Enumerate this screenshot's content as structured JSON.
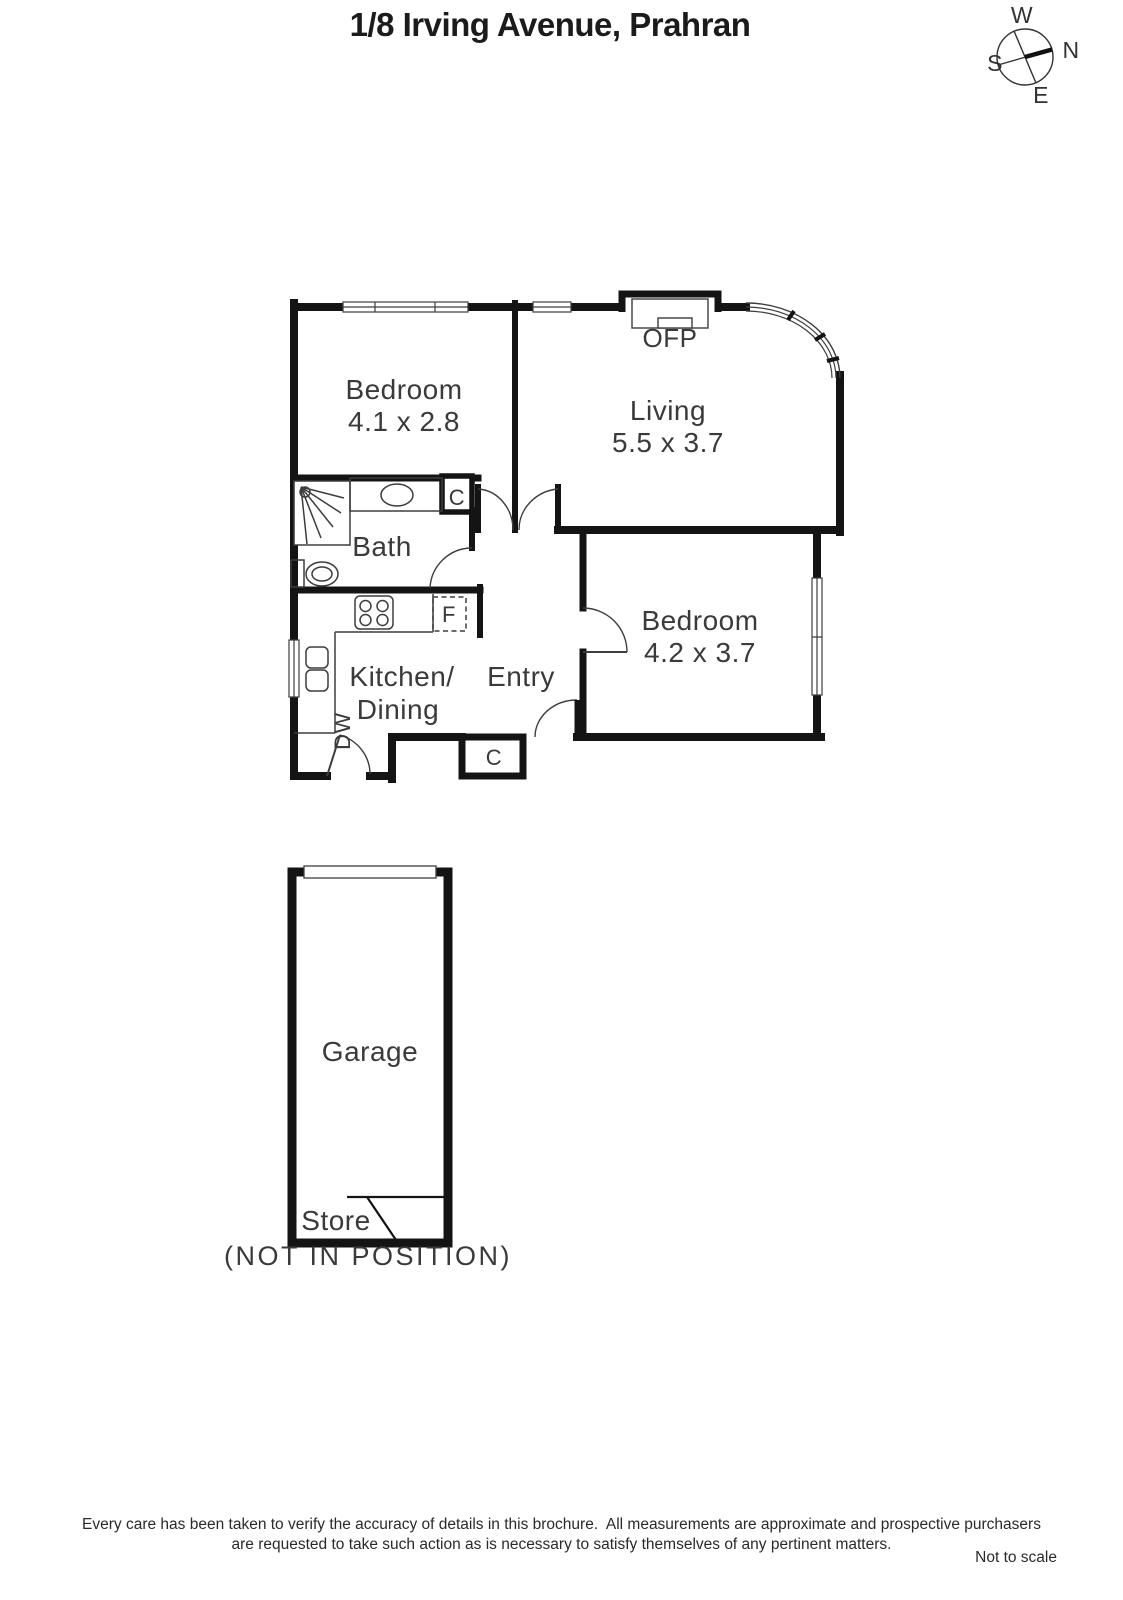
{
  "title": "1/8 Irving Avenue, Prahran",
  "compass": {
    "north": "N",
    "south": "S",
    "east": "E",
    "west": "W"
  },
  "floorplan": {
    "rooms": {
      "bedroom1": {
        "name": "Bedroom",
        "dims": "4.1 x 2.8"
      },
      "living": {
        "name": "Living",
        "dims": "5.5 x 3.7"
      },
      "bath": {
        "name": "Bath"
      },
      "kitchen": {
        "name_line1": "Kitchen/",
        "name_line2": "Dining"
      },
      "entry": {
        "name": "Entry"
      },
      "bedroom2": {
        "name": "Bedroom",
        "dims": "4.2 x 3.7"
      },
      "garage": {
        "name": "Garage"
      },
      "store": {
        "name": "Store"
      }
    },
    "labels": {
      "ofp": "OFP",
      "closet_bath": "C",
      "closet_entry": "C",
      "fridge": "F",
      "dishwasher": "DW",
      "not_in_position": "(NOT IN POSITION)"
    }
  },
  "footer": {
    "line1": "Every care has been taken to verify the accuracy of details in this brochure.  All measurements are approximate and prospective purchasers",
    "line2": "are requested to take such action as is necessary to satisfy themselves of any pertinent matters.",
    "scale_note": "Not to scale"
  },
  "colors": {
    "wall": "#141414",
    "line": "#3d3d3d",
    "text": "#3a3a3a"
  }
}
